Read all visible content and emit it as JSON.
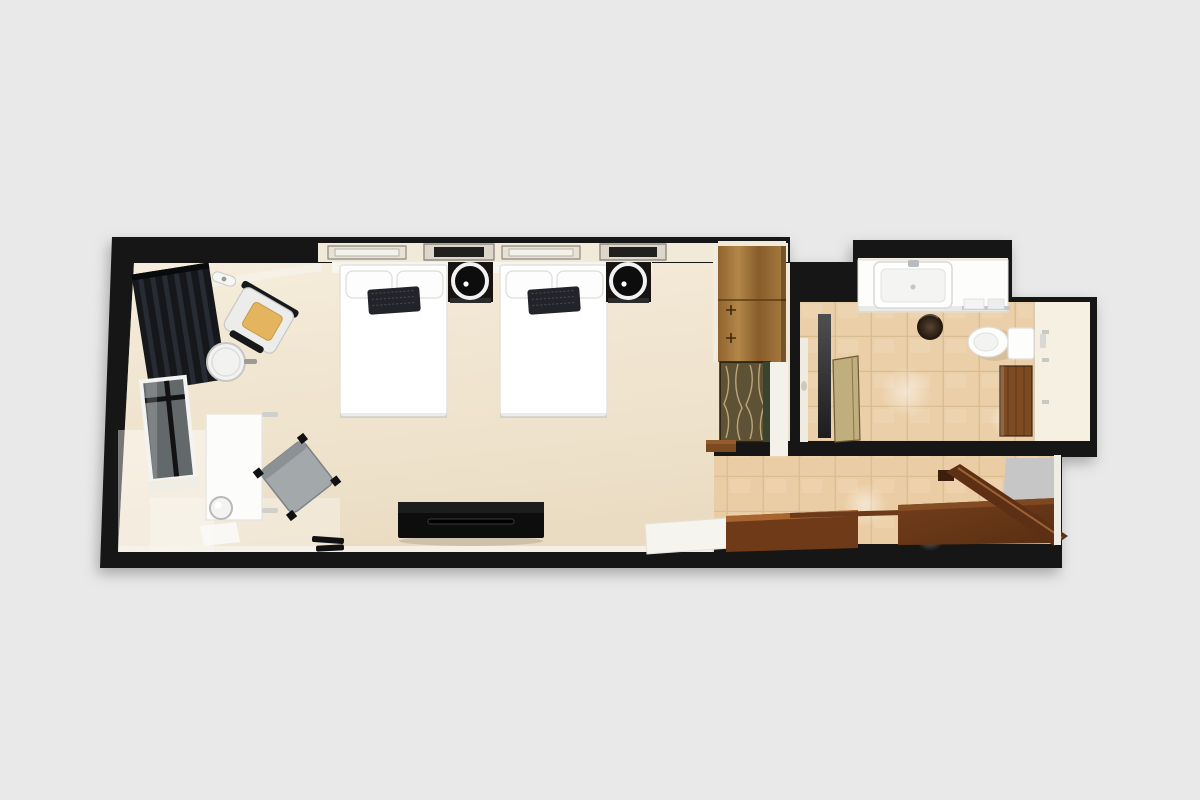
{
  "meta": {
    "kind": "3d-floor-plan-render",
    "view": "top-down",
    "subject": "hotel guest room with two beds, work desk, wardrobe, bathroom and entry hall"
  },
  "palette": {
    "background": "#e9e9e9",
    "wall": "#141414",
    "bedroom_floor": "#efe3ce",
    "inner_wall_face": "#f5f1e7",
    "cove_band": "#f2ead9",
    "headboard_band": "#f7f5ef",
    "tile": "#ebcfa8",
    "tile_grout": "#d9bd92",
    "alcove_floor": "#f2ede3",
    "shower_zone": "#f6f0e2",
    "linen_white": "#ffffff",
    "pillow_accent": "#23242a",
    "curtain_black": "#15171b",
    "window_glass": "#63686b",
    "armchair_body": "#ececea",
    "accent_cushion": "#e4b55e",
    "desk_white": "#fcfcfb",
    "chair_gray": "#a3a8ab",
    "console_black": "#0d0d0d",
    "nightstand_black": "#171310",
    "wardrobe_wood": "#a97c3f",
    "decor_panel": "#5d5136",
    "decor_panel_strokes": "#cdb584",
    "bath_cabinet_wood": "#7d4a22",
    "shower_door_tan": "#c0ae7e",
    "glass_dark_strip": "#333333",
    "porcelain": "#fdfdfc",
    "waste_bin": "#32261b",
    "threshold_wood": "#6e3a18",
    "entry_door_wood": "#5d3015",
    "step_white": "#f6f4ef",
    "outside_gray": "#c6c6c6"
  },
  "rooms": [
    {
      "name": "bedroom",
      "items": [
        "blackout-curtain",
        "window",
        "ceiling-spotlight",
        "armchair",
        "round-side-table",
        "desk",
        "kettle",
        "desk-chair",
        "twin-bed-1",
        "twin-bed-2",
        "nightstand-lamp-1",
        "nightstand-lamp-2",
        "ceiling-light-panels",
        "tv-console",
        "luggage-rack",
        "wardrobe",
        "decor-panel"
      ]
    },
    {
      "name": "bathroom",
      "items": [
        "vanity-counter",
        "sink-basin",
        "faucet",
        "waste-bin",
        "towel-rack",
        "toilet",
        "flush-plate",
        "storage-cabinet",
        "shower-glass-strip",
        "shower-door",
        "shower-zone"
      ]
    },
    {
      "name": "entry-hall",
      "items": [
        "tile-floor",
        "white-step",
        "wood-threshold-inner",
        "wood-threshold-outer",
        "entrance-door-open",
        "door-frame"
      ]
    }
  ]
}
